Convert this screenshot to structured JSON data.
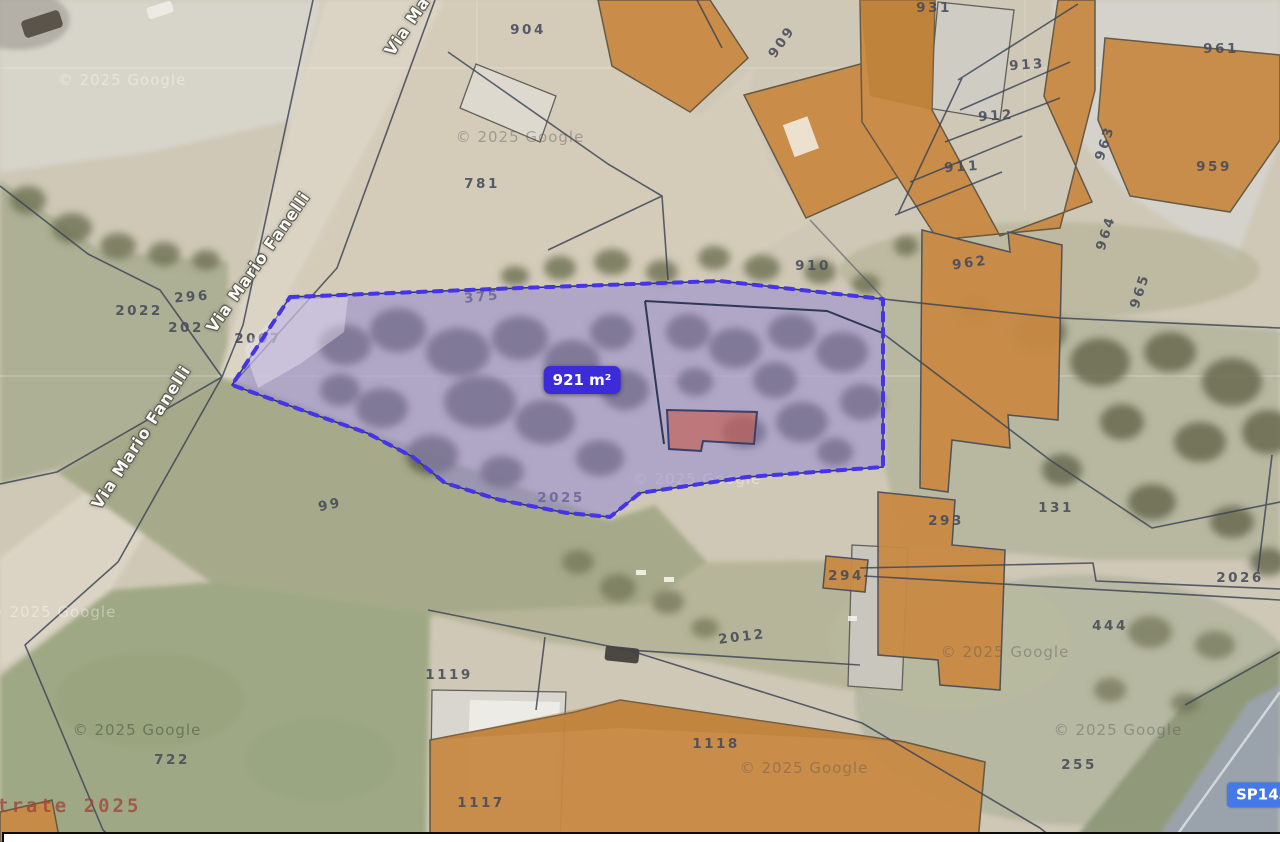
{
  "map": {
    "colors": {
      "selected_parcel_fill": "#9284d6",
      "selected_parcel_border": "#4534e8",
      "area_label_bg": "#3c2bd8",
      "road_badge_bg": "#4379e8",
      "parcel_number_color": "#444a5a",
      "building_fill": "#c98a44"
    },
    "area_label": {
      "text": "921 m²",
      "x": 582,
      "y": 380
    },
    "road_badge": {
      "text": "SP143",
      "x": 1227,
      "y": 795
    },
    "street_labels": [
      {
        "text": "Via Ma",
        "x": 407,
        "y": 26,
        "rot": -56
      },
      {
        "text": "Via Mario Fanelli",
        "x": 258,
        "y": 262,
        "rot": -55
      },
      {
        "text": "Via Mario Fanelli",
        "x": 141,
        "y": 437,
        "rot": -57
      }
    ],
    "parcel_numbers": [
      {
        "text": "904",
        "x": 528,
        "y": 30,
        "rot": 0
      },
      {
        "text": "931",
        "x": 934,
        "y": 8,
        "rot": 0
      },
      {
        "text": "909",
        "x": 782,
        "y": 42,
        "rot": -55
      },
      {
        "text": "961",
        "x": 1221,
        "y": 49,
        "rot": 0
      },
      {
        "text": "913",
        "x": 1027,
        "y": 65,
        "rot": -4
      },
      {
        "text": "912",
        "x": 996,
        "y": 116,
        "rot": -4
      },
      {
        "text": "911",
        "x": 962,
        "y": 167,
        "rot": -4
      },
      {
        "text": "963",
        "x": 1105,
        "y": 143,
        "rot": -72
      },
      {
        "text": "959",
        "x": 1214,
        "y": 167,
        "rot": 0
      },
      {
        "text": "781",
        "x": 482,
        "y": 184,
        "rot": 0
      },
      {
        "text": "964",
        "x": 1106,
        "y": 233,
        "rot": -72
      },
      {
        "text": "962",
        "x": 970,
        "y": 263,
        "rot": -8
      },
      {
        "text": "910",
        "x": 813,
        "y": 266,
        "rot": 0
      },
      {
        "text": "965",
        "x": 1140,
        "y": 291,
        "rot": -72
      },
      {
        "text": "375",
        "x": 482,
        "y": 297,
        "rot": -6
      },
      {
        "text": "296",
        "x": 192,
        "y": 297,
        "rot": -5
      },
      {
        "text": "2022",
        "x": 139,
        "y": 311,
        "rot": 0
      },
      {
        "text": "202",
        "x": 186,
        "y": 328,
        "rot": 0
      },
      {
        "text": "2007",
        "x": 258,
        "y": 339,
        "rot": 0
      },
      {
        "text": "99",
        "x": 330,
        "y": 505,
        "rot": -12
      },
      {
        "text": "2025",
        "x": 561,
        "y": 498,
        "rot": 0
      },
      {
        "text": "131",
        "x": 1056,
        "y": 508,
        "rot": 0
      },
      {
        "text": "293",
        "x": 946,
        "y": 521,
        "rot": 0
      },
      {
        "text": "294",
        "x": 846,
        "y": 576,
        "rot": 0
      },
      {
        "text": "2026",
        "x": 1240,
        "y": 578,
        "rot": 0
      },
      {
        "text": "444",
        "x": 1110,
        "y": 626,
        "rot": 0
      },
      {
        "text": "2012",
        "x": 742,
        "y": 637,
        "rot": -7
      },
      {
        "text": "1119",
        "x": 449,
        "y": 675,
        "rot": 0
      },
      {
        "text": "1118",
        "x": 716,
        "y": 744,
        "rot": 0
      },
      {
        "text": "255",
        "x": 1079,
        "y": 765,
        "rot": 0
      },
      {
        "text": "722",
        "x": 172,
        "y": 760,
        "rot": 0
      },
      {
        "text": "1117",
        "x": 481,
        "y": 803,
        "rot": 0
      }
    ],
    "watermarks": [
      {
        "text": "© 2025 Google",
        "x": 122,
        "y": 80,
        "tone": "light"
      },
      {
        "text": "© 2025 Google",
        "x": 520,
        "y": 137,
        "tone": "gray"
      },
      {
        "text": "© 2025 Google",
        "x": 697,
        "y": 479,
        "tone": "light"
      },
      {
        "text": "© 2025 Google",
        "x": 52,
        "y": 612,
        "tone": "light"
      },
      {
        "text": "© 2025 Google",
        "x": 137,
        "y": 730,
        "tone": "dark"
      },
      {
        "text": "© 2025 Google",
        "x": 1005,
        "y": 652,
        "tone": "gray"
      },
      {
        "text": "© 2025 Google",
        "x": 1118,
        "y": 730,
        "tone": "gray"
      },
      {
        "text": "© 2025 Google",
        "x": 804,
        "y": 768,
        "tone": "gray"
      },
      {
        "text": "ntrate 2025",
        "x": 62,
        "y": 806,
        "tone": "red"
      }
    ]
  }
}
